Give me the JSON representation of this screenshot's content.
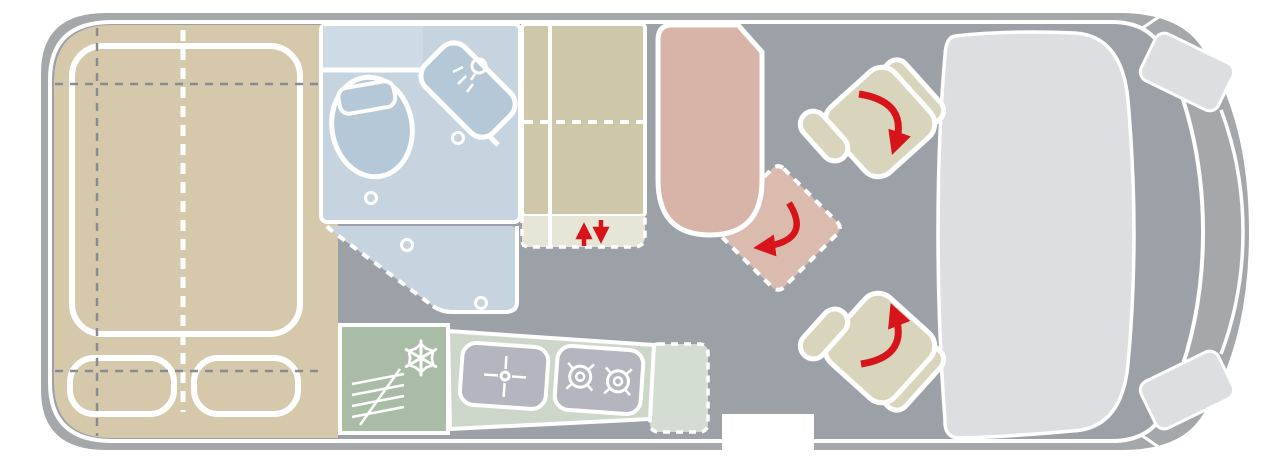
{
  "diagram": {
    "type": "campervan-floor-plan",
    "description": "Top-down floor plan of a campervan: rear double bed, wet bathroom, wardrobe, kitchenette, lounge bench with swivel position, two rotating cab seats, driver cab at front (right)",
    "orientation": {
      "vehicle_front": "right",
      "vehicle_rear": "left"
    }
  },
  "colors": {
    "floor": "#9ba1a6",
    "body_band": "#a4a8ab",
    "line_white": "#ffffff",
    "bed_beige": "#d6c9ab",
    "wardrobe_beige": "#cec7a9",
    "cabinet_light": "#e7e5d6",
    "seat_beige": "#d9d4bc",
    "bath_blue": "#c6d4df",
    "bath_blue_light": "#cfdbe4",
    "fixture_blue": "#b4c8d8",
    "fridge_green": "#a9bda6",
    "counter_green": "#cdd7c9",
    "counter_ext": "#d4ddd1",
    "appliance_gray": "#b4b5be",
    "bench_pink": "#d8b4a8",
    "swivel_pink": "#dcbbaf",
    "cab_gray": "#dcdee1",
    "dash_gray": "#868c90",
    "red": "#d8141b"
  },
  "areas": [
    {
      "id": "double-bed",
      "kind": "bed platform with mattress outline and two pillows",
      "color_key": "bed_beige"
    },
    {
      "id": "bathroom",
      "kind": "wet room with toilet, shower basin unit and dashed shower tray",
      "color_key": "bath_blue"
    },
    {
      "id": "wardrobe",
      "kind": "tall cabinet block with dashed shelf line",
      "color_key": "wardrobe_beige"
    },
    {
      "id": "lift-cabinet",
      "kind": "dashed lower element with up/down arrows",
      "color_key": "cabinet_light"
    },
    {
      "id": "kitchen",
      "kind": "kitchenette: fridge with snowflake, sink, two-burner hob, dashed worktop extension",
      "color_key": "fridge_green"
    },
    {
      "id": "dinette-bench",
      "kind": "lounge bench seat",
      "color_key": "bench_pink"
    },
    {
      "id": "swivel-position",
      "kind": "dashed rotated seat position with red rotation arrow",
      "color_key": "swivel_pink"
    },
    {
      "id": "cab-seat-top",
      "kind": "swivelling cab seat with red rotation arrow",
      "color_key": "seat_beige"
    },
    {
      "id": "cab-seat-bottom",
      "kind": "swivelling cab seat with red rotation arrow",
      "color_key": "seat_beige"
    },
    {
      "id": "cab",
      "kind": "driver cab / dashboard block with headlights",
      "color_key": "cab_gray"
    },
    {
      "id": "entry-door",
      "kind": "door cut-out in body at bottom centre",
      "color_key": "line_white"
    }
  ],
  "icons": [
    "snowflake-icon",
    "vent-grille-icon",
    "faucet-icon",
    "burner-icon",
    "shower-head-icon",
    "drain-icon",
    "rotation-arrow-icon",
    "up-arrow-icon",
    "down-arrow-icon"
  ]
}
